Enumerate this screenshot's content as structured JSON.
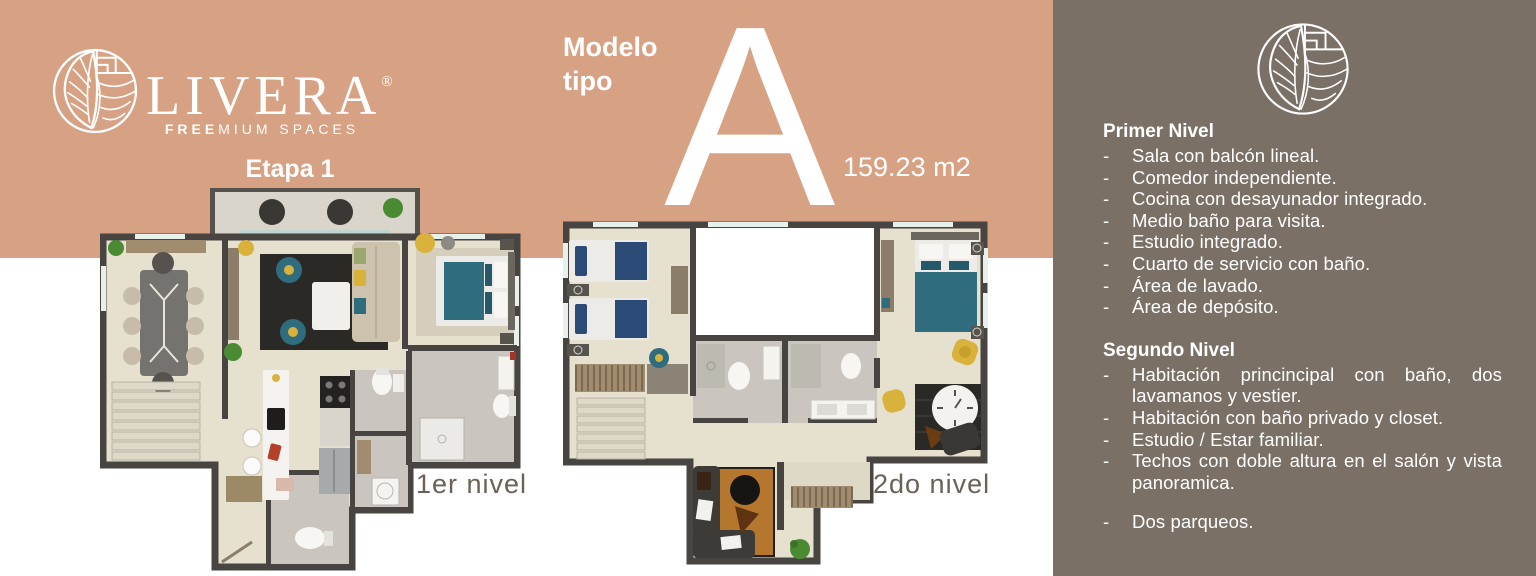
{
  "brand": {
    "name": "LIVERA",
    "registered": "®",
    "tagline_bold": "FREE",
    "tagline_rest": "MIUM SPACES",
    "stage": "Etapa 1"
  },
  "model": {
    "title_line1": "Modelo",
    "title_line2": "tipo",
    "letter": "A",
    "area": "159.23 m2"
  },
  "floor_plans": [
    {
      "label": "1er nivel"
    },
    {
      "label": "2do nivel"
    }
  ],
  "details_panel": {
    "bullet": "-",
    "first_level": {
      "title": "Primer Nivel",
      "items": [
        "Sala con balcón lineal.",
        "Comedor independiente.",
        "Cocina con desayunador integrado.",
        "Medio baño para visita.",
        "Estudio integrado.",
        "Cuarto de servicio con baño.",
        "Área de lavado.",
        "Área de depósito."
      ]
    },
    "second_level": {
      "title": "Segundo Nivel",
      "items": [
        "Habitación princincipal con baño, dos lavamanos y vestier.",
        "Habitación con baño privado y closet.",
        "Estudio / Estar familiar.",
        "Techos con doble altura en el salón y vista panoramica."
      ],
      "extra_items": [
        "Dos parqueos."
      ]
    }
  },
  "colors": {
    "peach_band": "#d7a183",
    "panel_brown": "#7a7065",
    "plan_label_text": "#6b6157",
    "plan_wall": "#474441",
    "plan_floor": "#e6e0cf",
    "accent_teal": "#2e6c7e",
    "accent_yellow": "#d9b23c"
  }
}
